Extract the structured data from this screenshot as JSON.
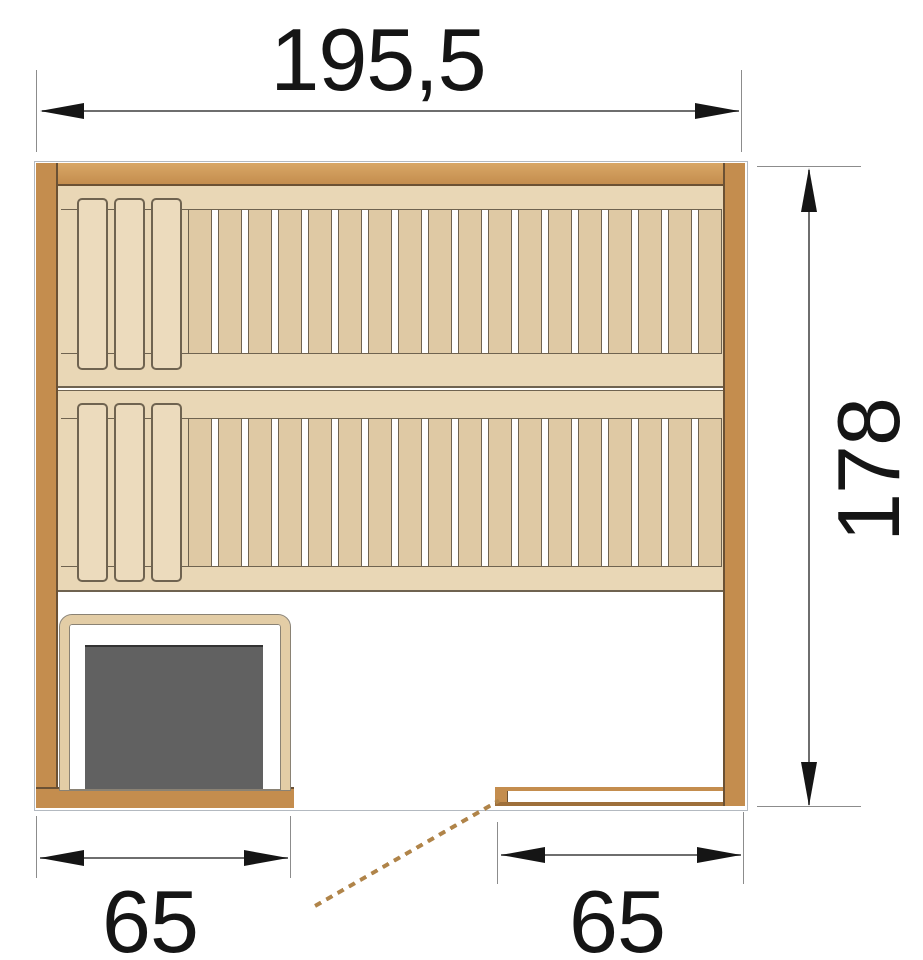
{
  "diagram": {
    "kind": "sauna-floor-plan-top-view",
    "dimensions": {
      "width": "195,5",
      "height": "178",
      "bottom_left_width": "65",
      "bottom_right_width": "65"
    },
    "benches": [
      {
        "label": "upper bench",
        "headrest_slats": 3,
        "seat_slats": 18
      },
      {
        "label": "lower bench",
        "headrest_slats": 3,
        "seat_slats": 18
      }
    ],
    "components": {
      "heater": "heater",
      "heater_guard": "heater guard rail",
      "door": "door swing (dashed)",
      "glass_front": "front panel with door opening"
    },
    "colors": {
      "wall": "#c48d4e",
      "wall_light": "#d9a766",
      "wall_dark": "#9e6f3a",
      "wall_line": "#6b5134",
      "bench_bg": "#e9d7b6",
      "slat": "#dfc9a4",
      "slat_wide": "#ecdbbd",
      "line": "#6f6350",
      "heater": "#616161",
      "guard": "#e3cda6",
      "guard_line": "#8a8274",
      "door": "#b08449",
      "dim_line": "#6e6e6e",
      "dim_ext": "#8c8c8c",
      "text": "#151515",
      "outline": "#b3b9c0"
    }
  }
}
